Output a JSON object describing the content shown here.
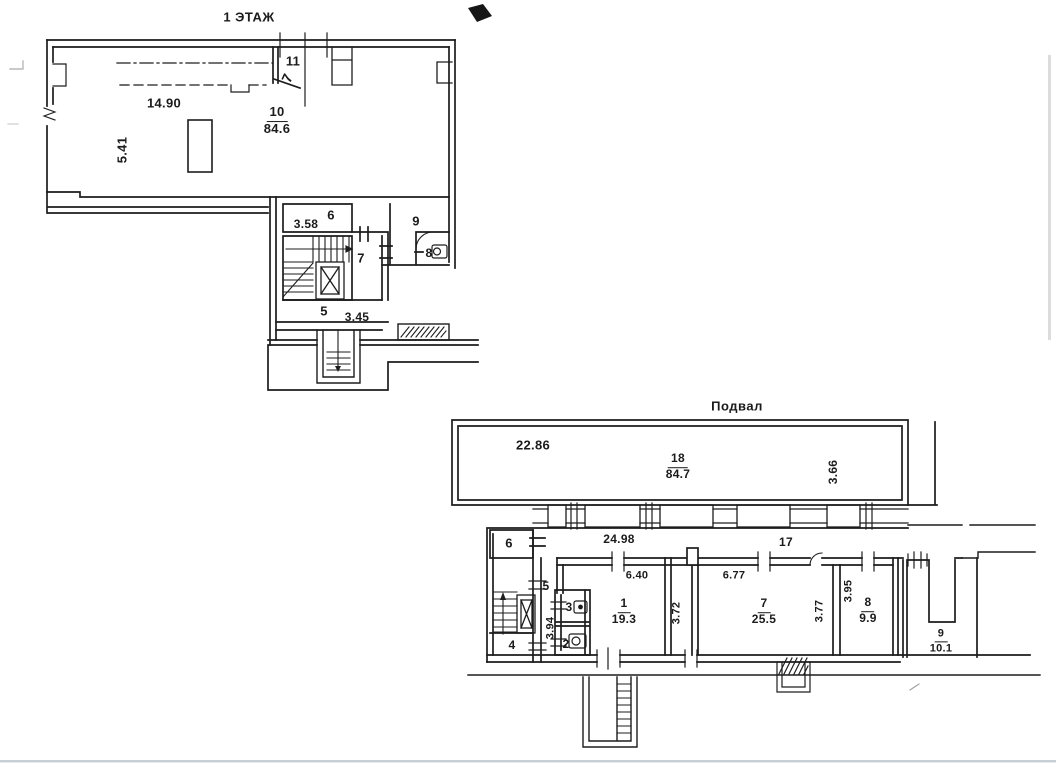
{
  "first_floor": {
    "title": "1 ЭТАЖ",
    "handwritten_mark": "7",
    "room_11": "11",
    "room_10": {
      "num": "10",
      "area": "84.6"
    },
    "dim_14_90": "14.90",
    "dim_5_41": "5.41",
    "room_6": "6",
    "dim_3_58": "3.58",
    "room_9": "9",
    "room_7": "7",
    "room_8": "8",
    "room_5": "5",
    "dim_3_45": "3.45"
  },
  "basement": {
    "title": "Подвал",
    "dim_22_86": "22.86",
    "room_18": {
      "num": "18",
      "area": "84.7"
    },
    "dim_3_66": "3.66",
    "room_6": "6",
    "dim_24_98": "24.98",
    "corridor_17": "17",
    "dim_6_40": "6.40",
    "dim_6_77": "6.77",
    "room_5": "5",
    "dim_3_95": "3.95",
    "room_3": "3",
    "room_1": {
      "num": "1",
      "area": "19.3"
    },
    "dim_3_72": "3.72",
    "room_7": {
      "num": "7",
      "area": "25.5"
    },
    "dim_3_77": "3.77",
    "room_8": {
      "num": "8",
      "area": "9.9"
    },
    "dim_3_94": "3.94",
    "room_2": "2",
    "room_4": "4",
    "room_9": {
      "num": "9",
      "area": "10.1"
    }
  },
  "colors": {
    "ink": "#1d1d1d",
    "scan_edge": "#c7ced4"
  }
}
